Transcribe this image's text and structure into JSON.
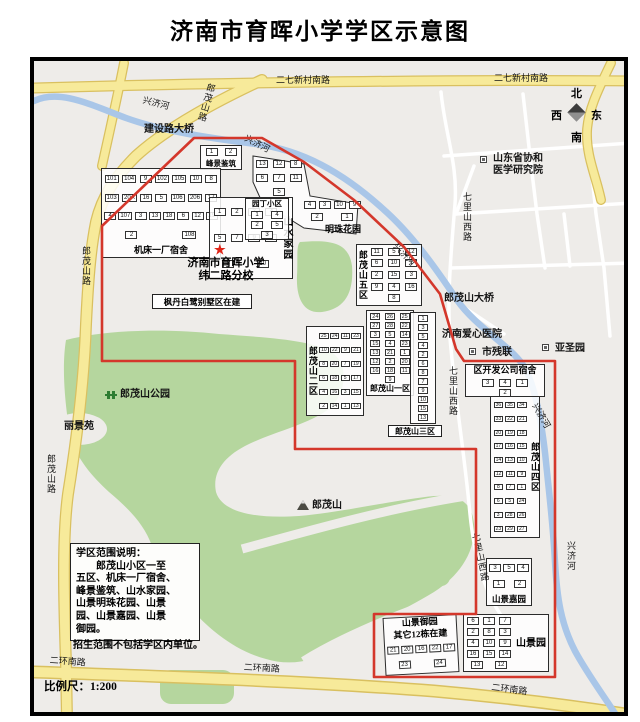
{
  "title": "济南市育晖小学学区示意图",
  "scale_label": "比例尺：1:200",
  "compass": {
    "north": "北",
    "west": "西",
    "east": "东",
    "south": "南"
  },
  "school": {
    "line1": "济南市育晖小学",
    "line2": "纬二路分校",
    "marker": "★"
  },
  "note": {
    "lines": [
      "学区范围说明：",
      "　　郎茂山小区一至",
      "五区、机床一厂宿舍、",
      "峰景鉴筑、山水家园、",
      "山景明珠花园、山景",
      "园、山景嘉园、山景",
      "御园。"
    ],
    "footer": "招生范围不包括学区内单位。"
  },
  "colors": {
    "boundary": "#d4372b",
    "road_major": "#f7ea9a",
    "road_casing": "#d9c060",
    "river": "#a9c6e8",
    "park_green": "#b5d69e",
    "map_bg": "#eeece9",
    "star_red": "#e02518",
    "frame_border": "#000000"
  },
  "districts": [
    {
      "id": "fengjing",
      "name": "峰景鉴筑",
      "x": 196,
      "y": 141,
      "w": 42,
      "h": 25,
      "pos": "bottom",
      "fs": 7.5,
      "buildings": [
        "1",
        "2"
      ]
    },
    {
      "id": "jichuang",
      "name": "机床一厂宿舍",
      "x": 97,
      "y": 164,
      "w": 120,
      "h": 90,
      "pos": "bottom",
      "fs": 9,
      "buildings": [
        "101",
        "104",
        "9",
        "102",
        "105",
        "10",
        "8",
        "103",
        "20A",
        "16",
        "5",
        "106",
        "206",
        "17",
        "4",
        "107",
        "3",
        "13",
        "18",
        "6",
        "12",
        "19",
        "2",
        "108"
      ]
    },
    {
      "id": "shanshui",
      "name": "山水家园",
      "x": 205,
      "y": 193,
      "w": 84,
      "h": 82,
      "pos": "right-v",
      "fs": 10,
      "buildings": [
        "1",
        "2",
        "3",
        "4",
        "5",
        "7",
        "9",
        "6",
        "8",
        "10"
      ]
    },
    {
      "id": "yuanding",
      "name": "园丁小区",
      "x": 241,
      "y": 194,
      "w": 44,
      "h": 42,
      "pos": "top",
      "fs": 7.5,
      "buildings": [
        "1",
        "4",
        "2",
        "5",
        "3"
      ]
    },
    {
      "id": "mingzhu-upper",
      "name": "",
      "x": 249,
      "y": 152,
      "w": 52,
      "h": 44,
      "pos": "none",
      "noborder": true,
      "buildings": [
        "13",
        "12",
        "8",
        "6",
        "7",
        "11",
        "5"
      ]
    },
    {
      "id": "mingzhu",
      "name": "明珠花园",
      "x": 297,
      "y": 194,
      "w": 62,
      "h": 38,
      "pos": "br",
      "fs": 9,
      "noborder": true,
      "buildings": [
        "4",
        "3",
        "10",
        "9",
        "2",
        "1"
      ]
    },
    {
      "id": "wuqu",
      "name": "郎茂山五区",
      "x": 352,
      "y": 240,
      "w": 66,
      "h": 62,
      "pos": "left-v",
      "fs": 9,
      "buildings": [
        "11",
        "5",
        "12",
        "6",
        "10",
        "1",
        "2",
        "15",
        "3",
        "9",
        "4",
        "16",
        "8"
      ]
    },
    {
      "id": "erqu",
      "name": "郎茂山二区",
      "x": 302,
      "y": 322,
      "w": 58,
      "h": 90,
      "pos": "left-v",
      "fs": 9,
      "xdense": true,
      "buildings": [
        "25",
        "24",
        "11",
        "23",
        "10",
        "22",
        "9",
        "21",
        "8",
        "20",
        "7",
        "19",
        "6",
        "18",
        "5",
        "17",
        "4",
        "16",
        "3",
        "15",
        "2",
        "14",
        "1",
        "13"
      ]
    },
    {
      "id": "yiqu",
      "name": "郎茂山一区",
      "x": 362,
      "y": 306,
      "w": 48,
      "h": 86,
      "pos": "bottom",
      "fs": 8,
      "dense": true,
      "buildings": [
        "24",
        "26",
        "25",
        "27",
        "28",
        "22",
        "3",
        "5",
        "14",
        "15",
        "4",
        "23",
        "13",
        "21",
        "1",
        "12",
        "2",
        "20",
        "16",
        "18",
        "11",
        "9"
      ]
    },
    {
      "id": "sanqu",
      "name": "",
      "x": 406,
      "y": 308,
      "w": 26,
      "h": 112,
      "pos": "none",
      "dense": true,
      "buildings": [
        "1",
        "3",
        "5",
        "4",
        "2",
        "6",
        "8",
        "7",
        "9",
        "10",
        "15",
        "13",
        "12"
      ]
    },
    {
      "id": "siqu",
      "name": "郎茂山四区",
      "x": 486,
      "y": 392,
      "w": 50,
      "h": 142,
      "pos": "right-v",
      "fs": 9,
      "xdense": true,
      "buildings": [
        "36",
        "35",
        "34",
        "33",
        "22",
        "21",
        "20",
        "19",
        "18",
        "17",
        "16",
        "15",
        "14",
        "13",
        "10",
        "12",
        "11",
        "9",
        "8",
        "7",
        "1",
        "6",
        "5",
        "24",
        "3",
        "28",
        "26",
        "23",
        "29",
        "27"
      ]
    },
    {
      "id": "qukaifa",
      "name": "区开发公司宿舍",
      "x": 461,
      "y": 360,
      "w": 80,
      "h": 33,
      "pos": "top",
      "fs": 9,
      "pad": true,
      "buildings": [
        "3",
        "4",
        "1",
        "2"
      ]
    },
    {
      "id": "shanjingjia",
      "name": "山景嘉园",
      "x": 482,
      "y": 554,
      "w": 46,
      "h": 48,
      "pos": "bottom",
      "fs": 8.5,
      "buildings": [
        "3",
        "5",
        "4",
        "1",
        "2"
      ]
    },
    {
      "id": "shanjingyuan",
      "name": "山景园",
      "x": 459,
      "y": 610,
      "w": 86,
      "h": 58,
      "pos": "right",
      "fs": 10,
      "buildings": [
        "6",
        "1",
        "7",
        "2",
        "8",
        "3",
        "4",
        "10",
        "9",
        "16",
        "15",
        "14",
        "13",
        "12"
      ]
    },
    {
      "id": "shanjingyu",
      "name": "山景御园",
      "name2": "其它12栋在建",
      "x": 380,
      "y": 612,
      "w": 74,
      "h": 58,
      "pos": "top2",
      "fs": 9,
      "rot": -3,
      "buildings": [
        "21",
        "20",
        "16",
        "22",
        "17",
        "23",
        "24"
      ]
    }
  ],
  "boxes": [
    {
      "text": "枫丹白鹭别墅区在建",
      "x": 148,
      "y": 290,
      "w": 100,
      "h": 15,
      "fs": 8.5
    },
    {
      "text": "郎茂山三区",
      "x": 384,
      "y": 421,
      "w": 54,
      "h": 12,
      "fs": 8
    }
  ],
  "labels": [
    {
      "t": "二七新村南路",
      "x": 272,
      "y": 72,
      "s": 9
    },
    {
      "t": "二七新村南路",
      "x": 490,
      "y": 70,
      "s": 9
    },
    {
      "t": "郎茂山路",
      "x": 203,
      "y": 78,
      "s": 9,
      "v": 1,
      "r": 16
    },
    {
      "t": "兴济河",
      "x": 140,
      "y": 92,
      "s": 9,
      "r": 14
    },
    {
      "t": "建设路大桥",
      "x": 140,
      "y": 121,
      "s": 10,
      "b": 1
    },
    {
      "t": "兴济河",
      "x": 243,
      "y": 130,
      "s": 9,
      "r": 27
    },
    {
      "t": "兴济河",
      "x": 394,
      "y": 238,
      "s": 9,
      "r": 46
    },
    {
      "t": "郎茂山大桥",
      "x": 440,
      "y": 290,
      "s": 10,
      "b": 1
    },
    {
      "t": "济南爱心医院",
      "x": 438,
      "y": 326,
      "s": 10,
      "b": 1
    },
    {
      "t": "市残联",
      "x": 478,
      "y": 344,
      "s": 10,
      "b": 1,
      "icon": "poi",
      "ix": -13,
      "iy": 0
    },
    {
      "t": "亚圣园",
      "x": 551,
      "y": 340,
      "s": 10,
      "b": 1,
      "icon": "poi",
      "ix": -13,
      "iy": 0
    },
    {
      "t": "山东省协和",
      "x": 489,
      "y": 150,
      "s": 10,
      "b": 1,
      "icon": "poi",
      "ix": -13,
      "iy": 2
    },
    {
      "t": "医学研究院",
      "x": 489,
      "y": 162,
      "s": 10,
      "b": 1
    },
    {
      "t": "七里山西路",
      "x": 458,
      "y": 188,
      "s": 9,
      "v": 1
    },
    {
      "t": "七里山西路",
      "x": 444,
      "y": 362,
      "s": 9,
      "v": 1
    },
    {
      "t": "七里山西路",
      "x": 466,
      "y": 530,
      "s": 9,
      "v": 1,
      "r": -12
    },
    {
      "t": "兴济河",
      "x": 534,
      "y": 398,
      "s": 9,
      "r": 60
    },
    {
      "t": "兴济河",
      "x": 562,
      "y": 537,
      "s": 9,
      "v": 1
    },
    {
      "t": "郎茂山路",
      "x": 77,
      "y": 242,
      "s": 9,
      "v": 1
    },
    {
      "t": "郎茂山路",
      "x": 42,
      "y": 450,
      "s": 9,
      "v": 1
    },
    {
      "t": "郎茂山公园",
      "x": 116,
      "y": 386,
      "s": 10,
      "b": 1,
      "icon": "park",
      "ix": -15,
      "iy": 1
    },
    {
      "t": "丽景苑",
      "x": 60,
      "y": 418,
      "s": 10,
      "b": 1
    },
    {
      "t": "郎茂山",
      "x": 308,
      "y": 497,
      "s": 10,
      "b": 1,
      "icon": "mountain",
      "ix": -15,
      "iy": -1
    },
    {
      "t": "二环南路",
      "x": 46,
      "y": 652,
      "s": 9,
      "r": 4
    },
    {
      "t": "二环南路",
      "x": 240,
      "y": 659,
      "s": 9,
      "r": 3
    },
    {
      "t": "二环南路",
      "x": 488,
      "y": 679,
      "s": 9,
      "r": 7
    }
  ]
}
